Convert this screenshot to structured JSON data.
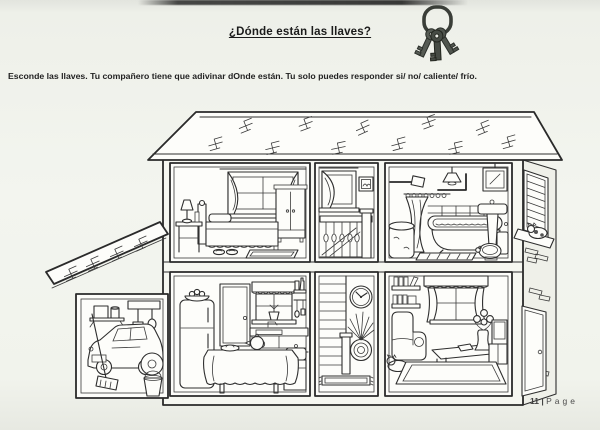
{
  "page": {
    "title": "¿Dónde están las llaves?",
    "instruction": "Esconde las llaves. Tu compañero  tiene que adivinar dOnde están. Tu solo puedes responder si/ no/ caliente/ frío.",
    "footer": {
      "number": "11 | ",
      "word": "Page"
    }
  },
  "icons": {
    "keys": "keys-icon",
    "keys_description": "keyring with three keys"
  },
  "illustration": {
    "name": "house-cross-section",
    "rooms_upper": [
      "bedroom",
      "landing",
      "bathroom"
    ],
    "rooms_lower": [
      "garage",
      "kitchen",
      "staircase",
      "living-room"
    ]
  },
  "colors": {
    "ink": "#2e2e2e",
    "paper": "#f3f5ef",
    "footer_text": "#4d4d4d",
    "keys_metal": "#565b54"
  }
}
